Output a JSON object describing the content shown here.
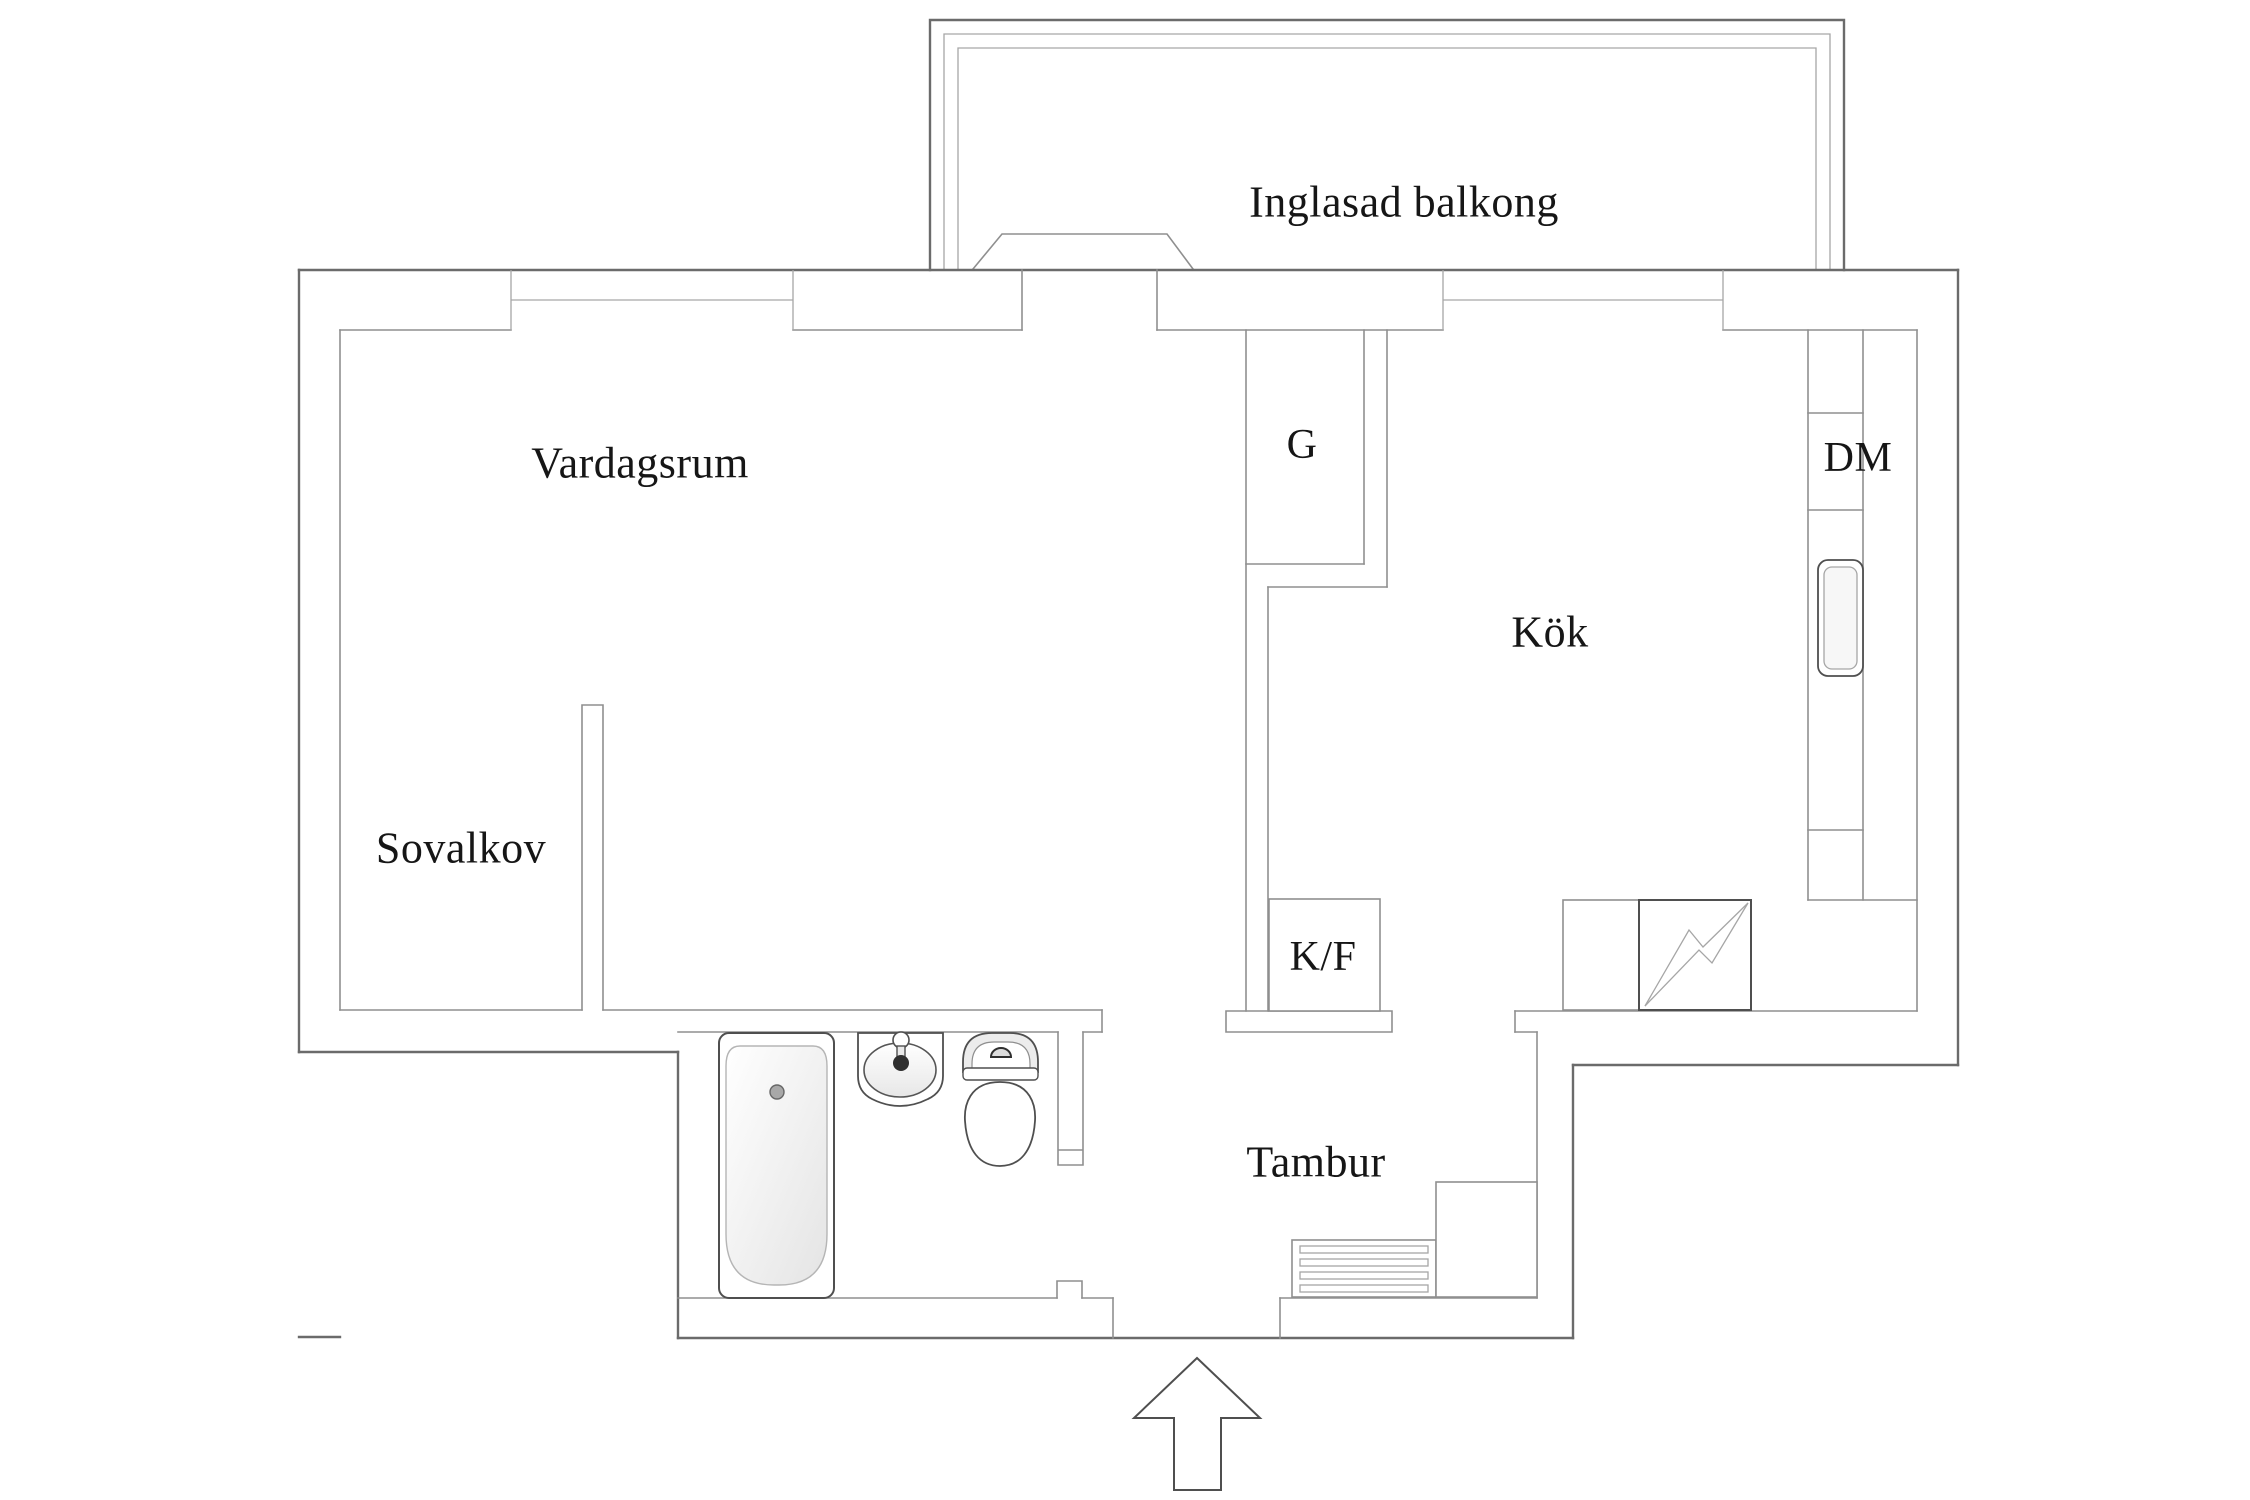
{
  "colors": {
    "background": "#ffffff",
    "outer_wall_line": "#6b6b6b",
    "inner_wall_line": "#8f8f8f",
    "detail_line": "#a6a6a6",
    "fixture_line": "#4f4f4f",
    "text": "#161616",
    "fixture_fill": "#efefef"
  },
  "rooms": {
    "balcony": {
      "label": "Inglasad balkong"
    },
    "living_room": {
      "label": "Vardagsrum"
    },
    "sleeping_alcove": {
      "label": "Sovalkov"
    },
    "kitchen": {
      "label": "Kök"
    },
    "hallway": {
      "label": "Tambur"
    }
  },
  "appliances": {
    "closet": {
      "label": "G"
    },
    "fridge_freezer": {
      "label": "K/F"
    },
    "dishwasher": {
      "label": "DM"
    }
  },
  "icons": {
    "bathtub": "bathtub-icon",
    "sink": "sink-icon",
    "toilet": "toilet-icon",
    "stove": "stove-lightning-icon",
    "shoe_rack": "shoe-rack-icon",
    "entry": "entry-arrow-icon"
  }
}
